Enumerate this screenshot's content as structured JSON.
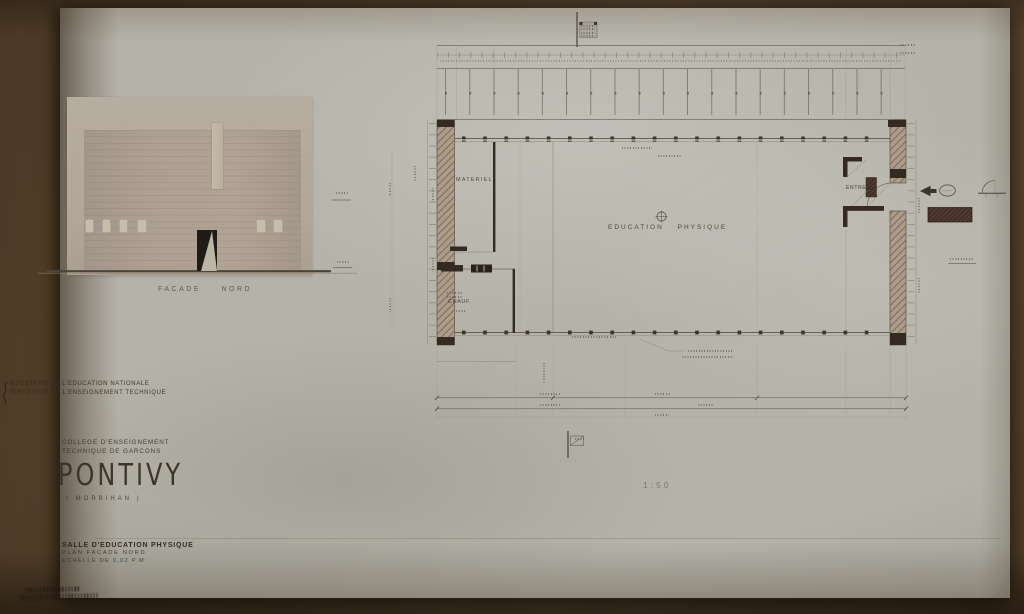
{
  "photo": {
    "board_color": "#5c4830",
    "sheet_color": "#b5b3a9",
    "wall_hatch_color": "#7c5a45",
    "ink_color": "#4a443b"
  },
  "ministry": {
    "line1": "MINISTERE DE L'EDUCATION NATIONALE",
    "line2": "DIRECTION DE L'ENSEIGNEMENT TECHNIQUE"
  },
  "title_block": {
    "line1": "COLLEGE D'ENSEIGNEMENT",
    "line2": "TECHNIQUE DE GARCONS",
    "city": "PONTIVY",
    "department": "( MORBIHAN )"
  },
  "drawing_block": {
    "line1": "SALLE D'EDUCATION PHYSIQUE",
    "line2": "PLAN FACADE NORD",
    "line3": "ECHELLE DE 0,02 P.M."
  },
  "elevation": {
    "caption": "FACADE NORD"
  },
  "plan": {
    "labels": {
      "materiel": "MATERIEL",
      "education": "EDUCATION PHYSIQUE",
      "chauf": "CHAUF.",
      "entree": "ENTREE"
    },
    "scale": "1:50"
  }
}
